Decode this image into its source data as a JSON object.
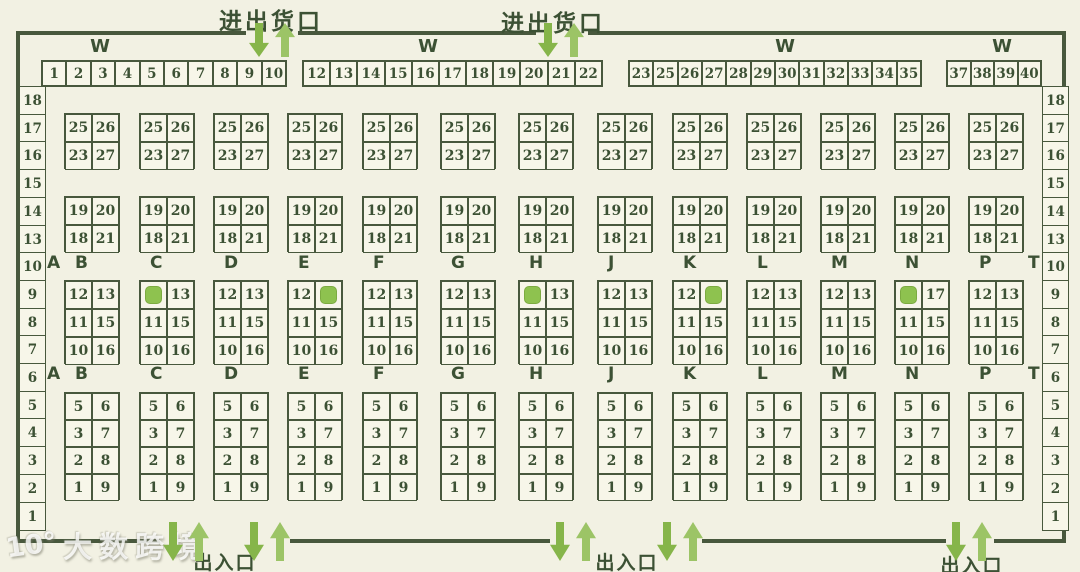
{
  "palette": {
    "background": "#f2f1e3",
    "cell_background": "#f7f6e9",
    "line": "#48583d",
    "text": "#3c5134",
    "arrow_dark": "#86b54a",
    "arrow_light": "#9cc466",
    "highlight": "#8ec24f"
  },
  "gates": {
    "top": [
      {
        "label": "进出货口"
      },
      {
        "label": "进出货口"
      }
    ],
    "bottom": [
      {
        "label": "出入口"
      },
      {
        "label": "出入口"
      },
      {
        "label": "出入口"
      }
    ]
  },
  "wall_label": "W",
  "top_row_groups": [
    [
      "1",
      "2",
      "3",
      "4",
      "5",
      "6",
      "7",
      "8",
      "9",
      "10"
    ],
    [
      "12",
      "13",
      "14",
      "15",
      "16",
      "17",
      "18",
      "19",
      "20",
      "21",
      "22"
    ],
    [
      "23",
      "25",
      "26",
      "27",
      "28",
      "29",
      "30",
      "31",
      "32",
      "33",
      "34",
      "35"
    ],
    [
      "37",
      "38",
      "39",
      "40"
    ]
  ],
  "side_labels": {
    "left": [
      "18",
      "17",
      "16",
      "15",
      "14",
      "13",
      "10",
      "9",
      "8",
      "7",
      "6",
      "5",
      "4",
      "3",
      "2",
      "1"
    ],
    "right": [
      "18",
      "17",
      "16",
      "15",
      "14",
      "13",
      "10",
      "9",
      "8",
      "7",
      "6",
      "5",
      "4",
      "3",
      "2",
      "1"
    ]
  },
  "aisle_letters": [
    "A",
    "B",
    "C",
    "D",
    "E",
    "F",
    "G",
    "H",
    "J",
    "K",
    "L",
    "M",
    "N",
    "P",
    "T"
  ],
  "rack_column_letters": [
    "B",
    "C",
    "D",
    "E",
    "F",
    "G",
    "H",
    "J",
    "K",
    "L",
    "M",
    "N",
    "P"
  ],
  "highlight_marker": "#",
  "rack_bands": [
    {
      "name": "rack-row-23-27",
      "grids": [
        [
          [
            "25",
            "26"
          ],
          [
            "23",
            "27"
          ]
        ],
        [
          [
            "25",
            "26"
          ],
          [
            "23",
            "27"
          ]
        ],
        [
          [
            "25",
            "26"
          ],
          [
            "23",
            "27"
          ]
        ],
        [
          [
            "25",
            "26"
          ],
          [
            "23",
            "27"
          ]
        ],
        [
          [
            "25",
            "26"
          ],
          [
            "23",
            "27"
          ]
        ],
        [
          [
            "25",
            "26"
          ],
          [
            "23",
            "27"
          ]
        ],
        [
          [
            "25",
            "26"
          ],
          [
            "23",
            "27"
          ]
        ],
        [
          [
            "25",
            "26"
          ],
          [
            "23",
            "27"
          ]
        ],
        [
          [
            "25",
            "26"
          ],
          [
            "23",
            "27"
          ]
        ],
        [
          [
            "25",
            "26"
          ],
          [
            "23",
            "27"
          ]
        ],
        [
          [
            "25",
            "26"
          ],
          [
            "23",
            "27"
          ]
        ],
        [
          [
            "25",
            "26"
          ],
          [
            "23",
            "27"
          ]
        ],
        [
          [
            "25",
            "26"
          ],
          [
            "23",
            "27"
          ]
        ]
      ]
    },
    {
      "name": "rack-row-18-21",
      "grids": [
        [
          [
            "19",
            "20"
          ],
          [
            "18",
            "21"
          ]
        ],
        [
          [
            "19",
            "20"
          ],
          [
            "18",
            "21"
          ]
        ],
        [
          [
            "19",
            "20"
          ],
          [
            "18",
            "21"
          ]
        ],
        [
          [
            "19",
            "20"
          ],
          [
            "18",
            "21"
          ]
        ],
        [
          [
            "19",
            "20"
          ],
          [
            "18",
            "21"
          ]
        ],
        [
          [
            "19",
            "20"
          ],
          [
            "18",
            "21"
          ]
        ],
        [
          [
            "19",
            "20"
          ],
          [
            "18",
            "21"
          ]
        ],
        [
          [
            "19",
            "20"
          ],
          [
            "18",
            "21"
          ]
        ],
        [
          [
            "19",
            "20"
          ],
          [
            "18",
            "21"
          ]
        ],
        [
          [
            "19",
            "20"
          ],
          [
            "18",
            "21"
          ]
        ],
        [
          [
            "19",
            "20"
          ],
          [
            "18",
            "21"
          ]
        ],
        [
          [
            "19",
            "20"
          ],
          [
            "18",
            "21"
          ]
        ],
        [
          [
            "19",
            "20"
          ],
          [
            "18",
            "21"
          ]
        ]
      ]
    },
    {
      "name": "rack-row-10-16",
      "grids": [
        [
          [
            "12",
            "13"
          ],
          [
            "11",
            "15"
          ],
          [
            "10",
            "16"
          ]
        ],
        [
          [
            "#",
            "13"
          ],
          [
            "11",
            "15"
          ],
          [
            "10",
            "16"
          ]
        ],
        [
          [
            "12",
            "13"
          ],
          [
            "11",
            "15"
          ],
          [
            "10",
            "16"
          ]
        ],
        [
          [
            "12",
            "#"
          ],
          [
            "11",
            "15"
          ],
          [
            "10",
            "16"
          ]
        ],
        [
          [
            "12",
            "13"
          ],
          [
            "11",
            "15"
          ],
          [
            "10",
            "16"
          ]
        ],
        [
          [
            "12",
            "13"
          ],
          [
            "11",
            "15"
          ],
          [
            "10",
            "16"
          ]
        ],
        [
          [
            "#",
            "13"
          ],
          [
            "11",
            "15"
          ],
          [
            "10",
            "16"
          ]
        ],
        [
          [
            "12",
            "13"
          ],
          [
            "11",
            "15"
          ],
          [
            "10",
            "16"
          ]
        ],
        [
          [
            "12",
            "#"
          ],
          [
            "11",
            "15"
          ],
          [
            "10",
            "16"
          ]
        ],
        [
          [
            "12",
            "13"
          ],
          [
            "11",
            "15"
          ],
          [
            "10",
            "16"
          ]
        ],
        [
          [
            "12",
            "13"
          ],
          [
            "11",
            "15"
          ],
          [
            "10",
            "16"
          ]
        ],
        [
          [
            "#",
            "17"
          ],
          [
            "11",
            "15"
          ],
          [
            "10",
            "16"
          ]
        ],
        [
          [
            "12",
            "13"
          ],
          [
            "11",
            "15"
          ],
          [
            "10",
            "16"
          ]
        ]
      ]
    },
    {
      "name": "rack-row-1-9",
      "grids": [
        [
          [
            "5",
            "6"
          ],
          [
            "3",
            "7"
          ],
          [
            "2",
            "8"
          ],
          [
            "1",
            "9"
          ]
        ],
        [
          [
            "5",
            "6"
          ],
          [
            "3",
            "7"
          ],
          [
            "2",
            "8"
          ],
          [
            "1",
            "9"
          ]
        ],
        [
          [
            "5",
            "6"
          ],
          [
            "3",
            "7"
          ],
          [
            "2",
            "8"
          ],
          [
            "1",
            "9"
          ]
        ],
        [
          [
            "5",
            "6"
          ],
          [
            "3",
            "7"
          ],
          [
            "2",
            "8"
          ],
          [
            "1",
            "9"
          ]
        ],
        [
          [
            "5",
            "6"
          ],
          [
            "3",
            "7"
          ],
          [
            "2",
            "8"
          ],
          [
            "1",
            "9"
          ]
        ],
        [
          [
            "5",
            "6"
          ],
          [
            "3",
            "7"
          ],
          [
            "2",
            "8"
          ],
          [
            "1",
            "9"
          ]
        ],
        [
          [
            "5",
            "6"
          ],
          [
            "3",
            "7"
          ],
          [
            "2",
            "8"
          ],
          [
            "1",
            "9"
          ]
        ],
        [
          [
            "5",
            "6"
          ],
          [
            "3",
            "7"
          ],
          [
            "2",
            "8"
          ],
          [
            "1",
            "9"
          ]
        ],
        [
          [
            "5",
            "6"
          ],
          [
            "3",
            "7"
          ],
          [
            "2",
            "8"
          ],
          [
            "1",
            "9"
          ]
        ],
        [
          [
            "5",
            "6"
          ],
          [
            "3",
            "7"
          ],
          [
            "2",
            "8"
          ],
          [
            "1",
            "9"
          ]
        ],
        [
          [
            "5",
            "6"
          ],
          [
            "3",
            "7"
          ],
          [
            "2",
            "8"
          ],
          [
            "1",
            "9"
          ]
        ],
        [
          [
            "5",
            "6"
          ],
          [
            "3",
            "7"
          ],
          [
            "2",
            "8"
          ],
          [
            "1",
            "9"
          ]
        ],
        [
          [
            "5",
            "6"
          ],
          [
            "3",
            "7"
          ],
          [
            "2",
            "8"
          ],
          [
            "1",
            "9"
          ]
        ]
      ]
    }
  ],
  "watermark": {
    "logo": "10°",
    "text": "大数跨境"
  }
}
